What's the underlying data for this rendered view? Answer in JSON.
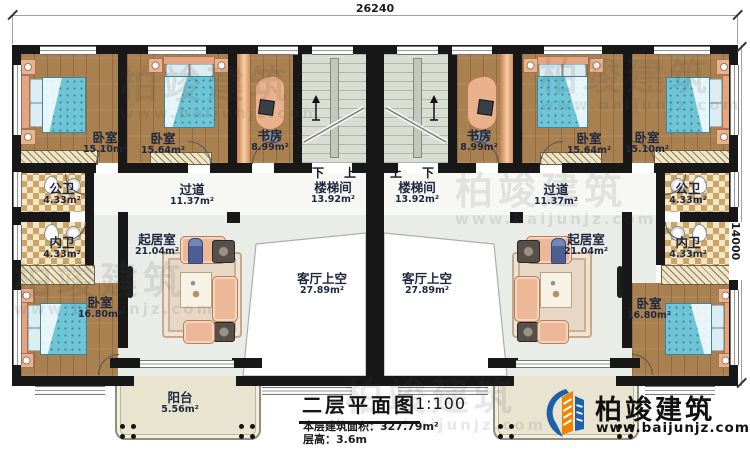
{
  "dimensions": {
    "width_top": "26240",
    "height_right": "14000"
  },
  "stairs": {
    "left": {
      "label": "楼梯间",
      "area": "13.92m²",
      "down": "下",
      "up": "上"
    },
    "right": {
      "label": "楼梯间",
      "area": "13.92m²",
      "down": "下",
      "up": "上"
    }
  },
  "rooms": {
    "bedroom_tl1": {
      "name": "卧室",
      "area": "15.10m²"
    },
    "bedroom_tl2": {
      "name": "卧室",
      "area": "15.64m²"
    },
    "study_l": {
      "name": "书房",
      "area": "8.99m²"
    },
    "corridor_l": {
      "name": "过道",
      "area": "11.37m²"
    },
    "pubbath_l": {
      "name": "公卫",
      "area": "4.33m²"
    },
    "privbath_l": {
      "name": "内卫",
      "area": "4.33m²"
    },
    "bedroom_bl": {
      "name": "卧室",
      "area": "16.80m²"
    },
    "living_l": {
      "name": "起居室",
      "area": "21.04m²"
    },
    "void_l": {
      "name": "客厅上空",
      "area": "27.89m²"
    },
    "balcony_l": {
      "name": "阳台",
      "area": "5.56m²"
    },
    "study_r": {
      "name": "书房",
      "area": "8.99m²"
    },
    "bedroom_tr2": {
      "name": "卧室",
      "area": "15.64m²"
    },
    "bedroom_tr1": {
      "name": "卧室",
      "area": "15.10m²"
    },
    "corridor_r": {
      "name": "过道",
      "area": "11.37m²"
    },
    "pubbath_r": {
      "name": "公卫",
      "area": "4.33m²"
    },
    "privbath_r": {
      "name": "内卫",
      "area": "4.33m²"
    },
    "bedroom_br": {
      "name": "卧室",
      "area": "16.80m²"
    },
    "living_r": {
      "name": "起居室",
      "area": "21.04m²"
    },
    "void_r": {
      "name": "客厅上空",
      "area": "27.89m²"
    }
  },
  "title_block": {
    "title": "二层平面图",
    "scale": "1:100",
    "area_line": "本层建筑面积：327.79m²",
    "floor_height_line": "层高：3.6m"
  },
  "logo": {
    "name": "柏竣建筑",
    "website": "www.baijunjz.com"
  },
  "watermark": {
    "name": "柏竣建筑",
    "website": "www.baijunjz.com"
  },
  "colors": {
    "wall": "#181818",
    "wood_floor": "#a9804f",
    "stair_floor": "#d9ded3",
    "bath_tile": "#cda468",
    "living_floor": "#e9ece7",
    "balcony_floor": "#e8e4d0",
    "bed_blue": "#6fc4d6",
    "sofa_salmon": "#ecb897",
    "logo_orange": "#f08300",
    "logo_blue": "#1e5fa9",
    "label_text": "#1f2740"
  }
}
